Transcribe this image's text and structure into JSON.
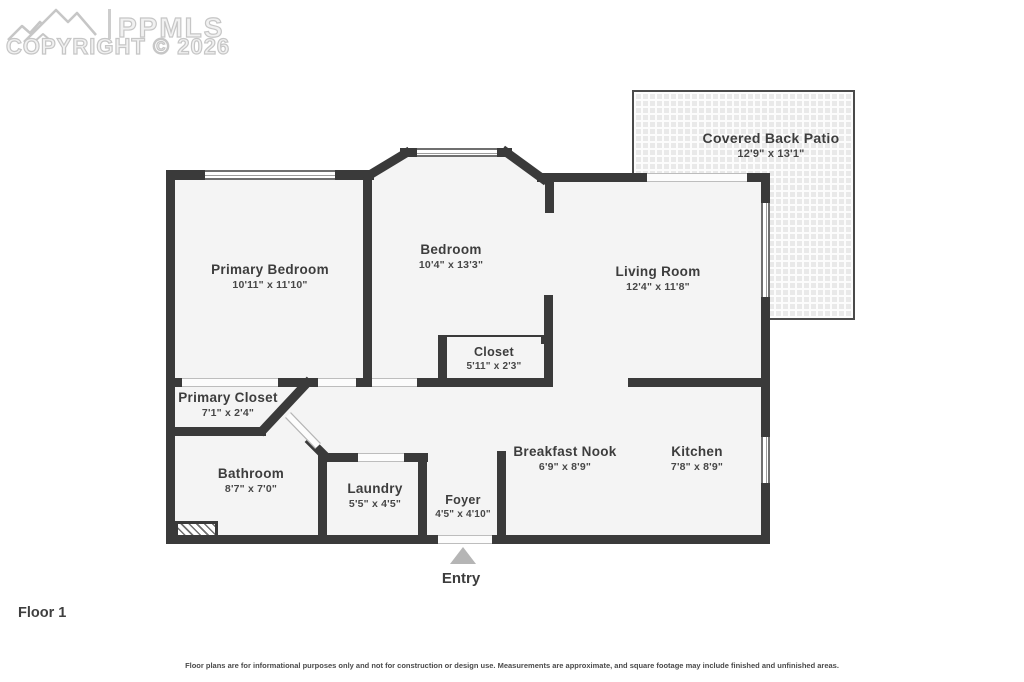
{
  "watermark": {
    "logo_text": "PPMLS",
    "copyright": "COPYRIGHT © 2026"
  },
  "floor_label": "Floor 1",
  "entry_label": "Entry",
  "disclaimer": "Floor plans are for informational purposes only and not for construction or design use. Measurements are approximate, and square footage may include finished and unfinished areas.",
  "rooms": [
    {
      "id": "covered-back-patio",
      "name": "Covered Back Patio",
      "dims": "12'9\" x 13'1\""
    },
    {
      "id": "primary-bedroom",
      "name": "Primary Bedroom",
      "dims": "10'11\" x 11'10\""
    },
    {
      "id": "bedroom",
      "name": "Bedroom",
      "dims": "10'4\" x 13'3\""
    },
    {
      "id": "living-room",
      "name": "Living Room",
      "dims": "12'4\" x 11'8\""
    },
    {
      "id": "closet",
      "name": "Closet",
      "dims": "5'11\" x 2'3\""
    },
    {
      "id": "primary-closet",
      "name": "Primary Closet",
      "dims": "7'1\" x 2'4\""
    },
    {
      "id": "bathroom",
      "name": "Bathroom",
      "dims": "8'7\" x 7'0\""
    },
    {
      "id": "laundry",
      "name": "Laundry",
      "dims": "5'5\" x 4'5\""
    },
    {
      "id": "foyer",
      "name": "Foyer",
      "dims": "4'5\" x 4'10\""
    },
    {
      "id": "breakfast-nook",
      "name": "Breakfast Nook",
      "dims": "6'9\" x 8'9\""
    },
    {
      "id": "kitchen",
      "name": "Kitchen",
      "dims": "7'8\" x 8'9\""
    }
  ],
  "colors": {
    "wall": "#3a3a3a",
    "room_fill": "#f4f4f4",
    "patio_tile": "#e9e9e9",
    "entry_arrow": "#b5b5b5",
    "watermark": "#c6c6c6"
  }
}
